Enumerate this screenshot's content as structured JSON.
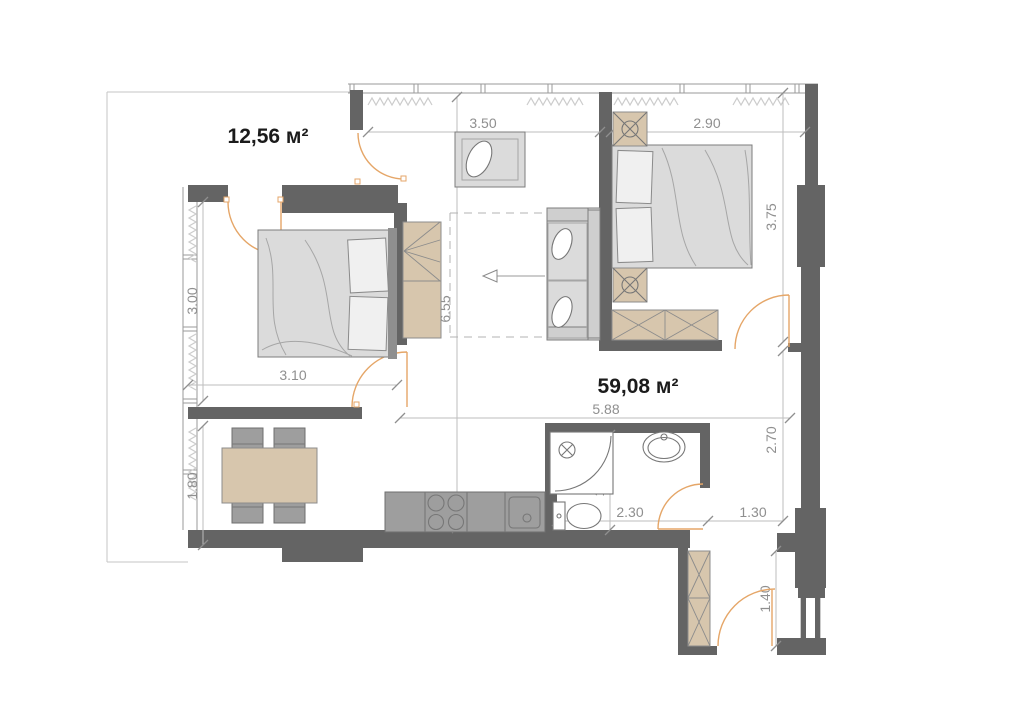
{
  "floorplan": {
    "title": "apartment-floor-plan",
    "area_labels": {
      "bedroom_left": "12,56 м²",
      "apartment_total": "59,08 м²"
    },
    "dimensions": {
      "dressing_width": "3.50",
      "bedroom_right_width": "2.90",
      "bedroom_right_height": "3.75",
      "bedroom_left_window": "3.00",
      "apartment_depth": "6.55",
      "bedroom_left_width": "3.10",
      "living_width": "5.88",
      "dining_height": "1.80",
      "bathroom_height": "1.50",
      "bathroom_width": "2.30",
      "hall_width": "1.30",
      "hall_height": "2.70",
      "entry_width": "1.40"
    },
    "colors": {
      "wall": "#646464",
      "furniture_gray": "#dbdbdb",
      "furniture_beige": "#d7c6ad",
      "door_arc": "#e5a668",
      "dimension_text": "#8f8f8f",
      "area_text": "#1b1b1b"
    },
    "icons": [
      "radiator-zigzag-icon",
      "door-swing-arc-icon",
      "stove-burners-icon",
      "kitchen-sink-icon",
      "shower-icon",
      "toilet-icon",
      "washbasin-icon",
      "sofa-fold-out-arrow-icon",
      "nightstand-lamp-icon",
      "wardrobe-cross-icon"
    ]
  }
}
